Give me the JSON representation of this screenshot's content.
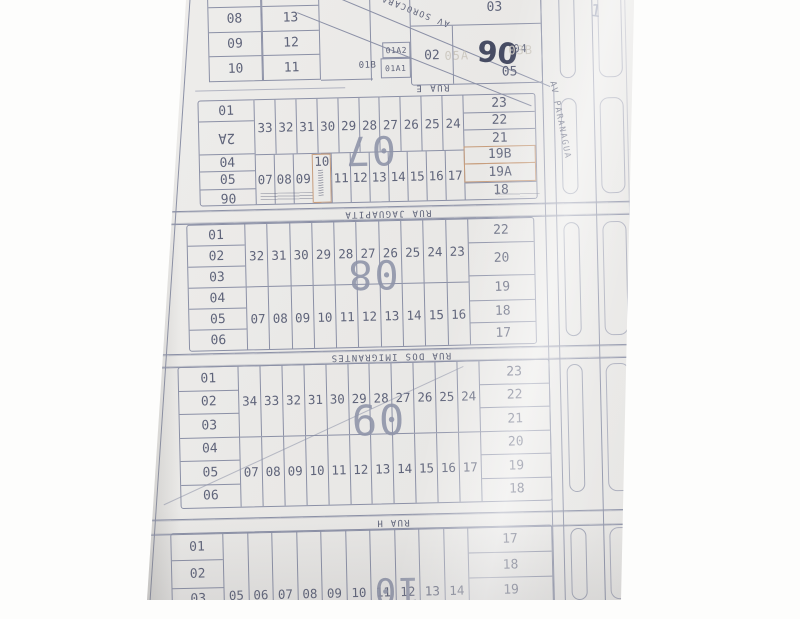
{
  "colors": {
    "paper": "#eae9e7",
    "line": "#8b90a6",
    "ink": "#5f647a",
    "big": "#9095aa",
    "accent": "#c79d7c",
    "pencil": "#cdc9c1",
    "handink": "#474c63"
  },
  "streets": {
    "av_sorocaba": "AV SOROCABA",
    "av_paranagua": "AV PARANAGUA",
    "rua_e": "RUA E",
    "rua_jaguapita": "RUA JAGUAPITA",
    "rua_imigrantes": "RUA DOS IMIGRANTES",
    "rua_h": "RUA H"
  },
  "mini_grid": {
    "left": [
      "07",
      "08",
      "09",
      "10"
    ],
    "right": [
      "14",
      "13",
      "12",
      "11"
    ]
  },
  "block06": {
    "number": "06",
    "lot_03": "03",
    "lot_02": "02",
    "lot_04": "04",
    "lot_05": "05",
    "lot_01a2": "01A2",
    "lot_01a1": "01A1",
    "lot_01b": "01B",
    "faint_a": "05A",
    "faint_b": "03B"
  },
  "block07": {
    "number": "07",
    "left": [
      "01",
      "2A",
      "04",
      "05",
      "06"
    ],
    "top_row": [
      "33",
      "32",
      "31",
      "30",
      "29",
      "28",
      "27",
      "26",
      "25",
      "24"
    ],
    "bottom_row": [
      "07",
      "08",
      "09",
      "10",
      "11",
      "12",
      "13",
      "14",
      "15",
      "16",
      "17"
    ],
    "right": [
      "23",
      "22",
      "21",
      "19B",
      "19A",
      "18"
    ]
  },
  "block08": {
    "number": "08",
    "left": [
      "01",
      "02",
      "03",
      "04",
      "05",
      "06"
    ],
    "top_row": [
      "32",
      "31",
      "30",
      "29",
      "28",
      "27",
      "26",
      "25",
      "24",
      "23"
    ],
    "bottom_row": [
      "07",
      "08",
      "09",
      "10",
      "11",
      "12",
      "13",
      "14",
      "15",
      "16"
    ],
    "right": [
      "22",
      "20",
      "19",
      "18",
      "17"
    ]
  },
  "block09": {
    "number": "09",
    "left": [
      "01",
      "02",
      "03",
      "04",
      "05",
      "06"
    ],
    "top_row": [
      "34",
      "33",
      "32",
      "31",
      "30",
      "29",
      "28",
      "27",
      "26",
      "25",
      "24"
    ],
    "bottom_row": [
      "07",
      "08",
      "09",
      "10",
      "11",
      "12",
      "13",
      "14",
      "15",
      "16",
      "17"
    ],
    "right": [
      "23",
      "22",
      "21",
      "20",
      "19",
      "18"
    ]
  },
  "block10": {
    "number": "10",
    "left": [
      "01",
      "02",
      "03"
    ],
    "bottom_row": [
      "05",
      "06",
      "07",
      "08",
      "09",
      "10",
      "11",
      "12",
      "13",
      "14"
    ],
    "right": [
      "17",
      "18",
      "19"
    ]
  },
  "misc": {
    "top_right_partial": "1"
  }
}
